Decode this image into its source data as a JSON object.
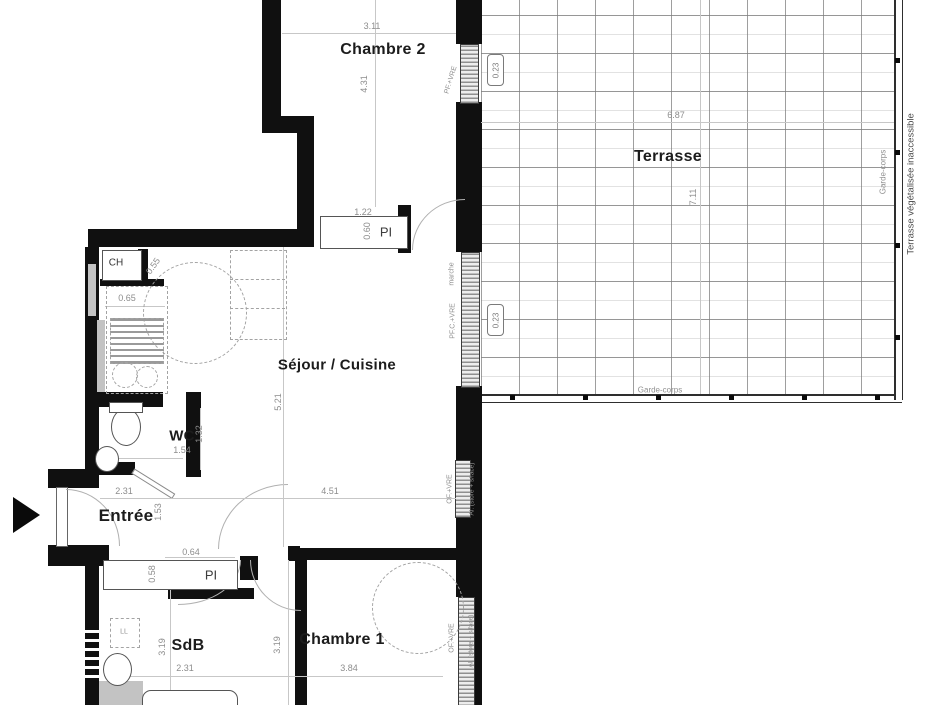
{
  "rooms": {
    "chambre2": {
      "label": "Chambre 2",
      "width": "3.11",
      "height": "4.31"
    },
    "terrasse": {
      "label": "Terrasse",
      "width": "6.87",
      "height": "7.11",
      "rail_label": "Garde-corps",
      "outside_note": "Terrasse végétalisée inaccessible",
      "door_width": "0.23"
    },
    "sejour": {
      "label": "Séjour / Cuisine",
      "width": "4.51",
      "height": "5.21"
    },
    "wc": {
      "label": "WC",
      "width": "1.54",
      "height": "1.32"
    },
    "entree": {
      "label": "Entrée",
      "width": "2.31",
      "height": "1.53"
    },
    "sdb": {
      "label": "SdB",
      "width": "2.31",
      "height": "3.19"
    },
    "chambre1": {
      "label": "Chambre 1",
      "width": "3.84",
      "height": "3.19"
    }
  },
  "closets": {
    "pi_chambre2": {
      "label": "PI",
      "width": "1.22",
      "depth": "0.60"
    },
    "pi_entree": {
      "label": "PI",
      "width": "0.64",
      "depth": "0.58"
    },
    "ch": {
      "label": "CH",
      "door": "0.55"
    }
  },
  "kitchen": {
    "counter_depth": "0.65"
  },
  "windows": {
    "chambre2": {
      "label": "PF.+VRE"
    },
    "sejour_terrasse": {
      "label": "PF.C.+VRE",
      "step": "marche"
    },
    "sejour": {
      "label": "OF.+VRE",
      "blind": "Al. (store + s/face)"
    },
    "chambre1": {
      "label": "OF.+VRE",
      "blind": "Al. (store + s/face)"
    }
  },
  "equipment": {
    "washer": "LL"
  }
}
